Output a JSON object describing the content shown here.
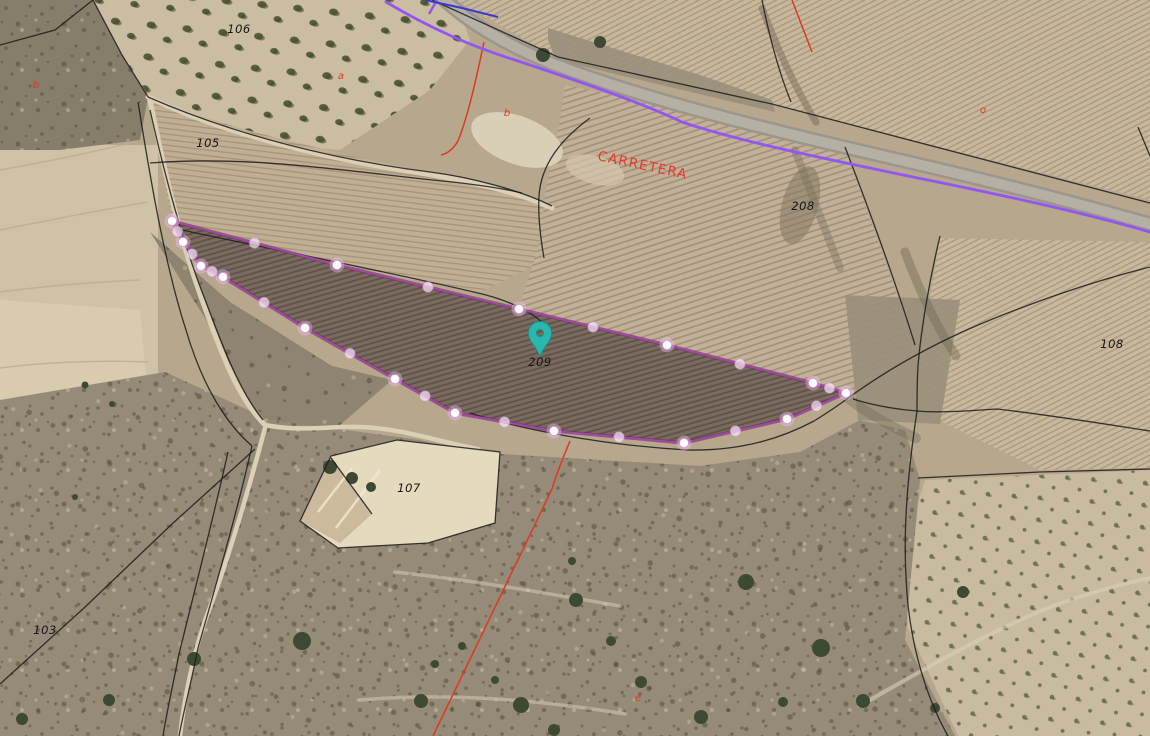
{
  "map": {
    "description": "Aerial cadastral map view with selected parcel 209, purple road line, red cadastral lines and parcel number labels",
    "colors": {
      "boundary": "#1b1b1b",
      "cadastral_red": "#e0381f",
      "road_line_purple": "#9257f2",
      "utility_blue": "#3a3ad0",
      "parcel_stroke": "#a546a5",
      "parcel_fill": "rgba(160,70,160,0.10)",
      "marker_teal": "#2bb7ae",
      "label_black": "#151515"
    },
    "road_label": {
      "text": "CARRETERA",
      "x": 597,
      "y": 160,
      "rotation": 12,
      "color": "#e8392a"
    },
    "parcel_labels": [
      {
        "text": "106",
        "x": 239,
        "y": 33
      },
      {
        "text": "105",
        "x": 208,
        "y": 147
      },
      {
        "text": "208",
        "x": 803,
        "y": 210
      },
      {
        "text": "209",
        "x": 540,
        "y": 366
      },
      {
        "text": "108",
        "x": 1112,
        "y": 348
      },
      {
        "text": "107",
        "x": 409,
        "y": 492
      },
      {
        "text": "103",
        "x": 45,
        "y": 634
      }
    ],
    "use_code_labels": [
      {
        "text": "b",
        "x": 36,
        "y": 88
      },
      {
        "text": "a",
        "x": 341,
        "y": 79
      },
      {
        "text": "b",
        "x": 507,
        "y": 116
      },
      {
        "text": "o",
        "x": 983,
        "y": 113
      },
      {
        "text": "e",
        "x": 638,
        "y": 701
      }
    ],
    "marker": {
      "name": "location-pin",
      "x": 540,
      "y": 356,
      "color": "#2bb7ae"
    },
    "selected_parcel": {
      "id": "209",
      "stroke": "#a546a5",
      "fill": "rgba(160,70,160,0.10)",
      "corners": [
        [
          172,
          221
        ],
        [
          337,
          265
        ],
        [
          519,
          309
        ],
        [
          667,
          345
        ],
        [
          813,
          383
        ],
        [
          846,
          393
        ],
        [
          787,
          419
        ],
        [
          684,
          443
        ],
        [
          554,
          431
        ],
        [
          455,
          413
        ],
        [
          395,
          379
        ],
        [
          305,
          328
        ],
        [
          223,
          277
        ],
        [
          201,
          266
        ],
        [
          183,
          242
        ]
      ]
    },
    "overlay_lines": {
      "purple_road": "M386,2 C430,28 470,46 518,61 C575,80 640,102 682,122 C740,142 845,163 952,185 C1030,201 1095,216 1150,232",
      "purple_branch": "M437,0 L429,14",
      "blue_utility": "M425,0 L462,8 L498,17",
      "red_lines": [
        "M484,42 C476,80 468,116 458,141 C452,151 446,154 441,155",
        "M570,441 C563,458 557,472 552,489 L433,736",
        "M792,0 L812,52"
      ],
      "black_boundaries": [
        "M432,0 L558,57 L772,104 L1150,203",
        "M93,0 L122,55 L148,97",
        "M148,97 C235,135 335,160 430,172 C470,177 520,190 552,206",
        "M150,163 C255,155 350,172 452,182 C480,185 505,189 522,193",
        "M150,110 C168,190 186,252 206,302 C222,345 240,392 263,420",
        "M138,102 C152,190 166,268 186,330 C200,378 222,420 252,446",
        "M252,446 C238,508 218,578 198,648 C190,688 183,714 179,736",
        "M228,452 C214,515 196,585 179,654 C171,694 166,716 163,736",
        "M255,449 L172,524 L84,608 L0,684",
        "M177,229 C280,251 390,272 478,293 C512,301 536,314 550,330",
        "M470,413 C520,429 600,445 688,450 C742,451 782,438 814,421 C832,410 843,402 851,396",
        "M851,396 C890,368 935,342 995,318 C1060,292 1110,277 1150,267",
        "M853,399 C872,405 893,409 917,411",
        "M917,411 C909,465 903,522 906,577 C908,632 922,690 948,736",
        "M917,411 C940,413 965,411 997,409 C1050,415 1105,424 1150,431",
        "M940,236 C929,282 921,330 918,366 C917,382 917,397 917,411",
        "M590,118 C560,140 541,165 539,196 C538,214 540,235 544,258",
        "M762,0 C770,40 780,75 791,102",
        "M1138,127 L1150,156",
        "M918,478 L1040,472 L1150,469",
        "M0,45 L55,30 L93,0",
        "M845,147 C870,212 895,280 915,345",
        "M300,521 L331,456 L397,440 L500,452 L495,523 L428,543 L338,548 Z",
        "M331,458 L372,514"
      ]
    }
  }
}
